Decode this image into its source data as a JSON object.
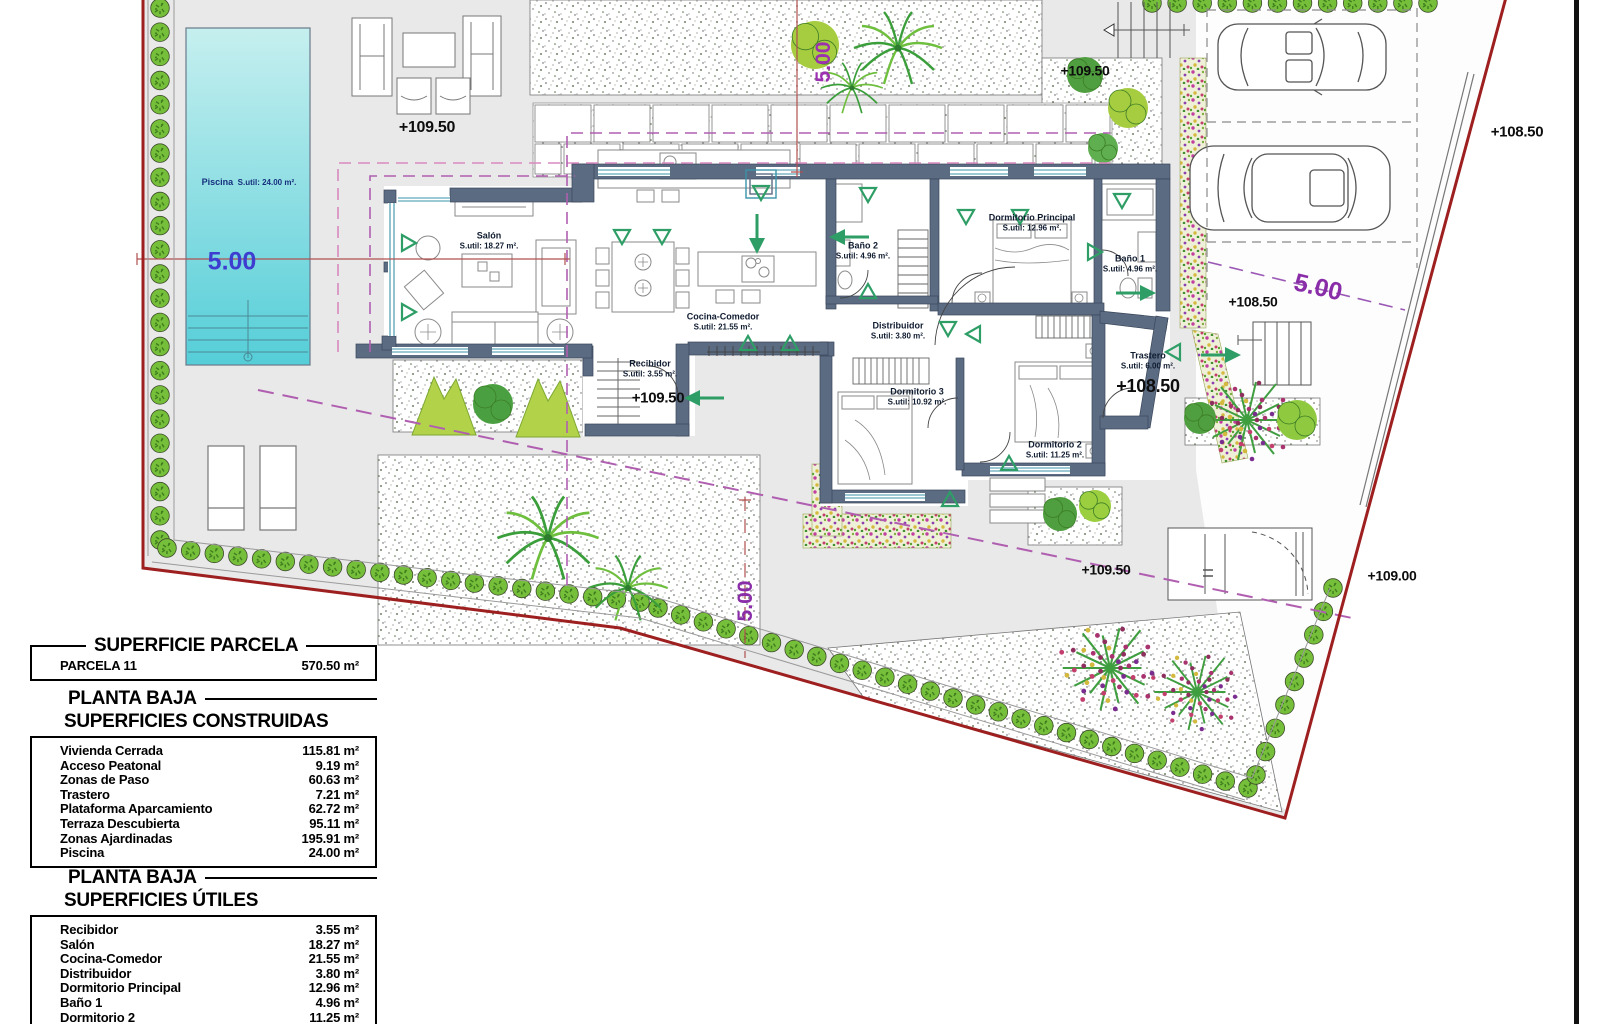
{
  "plan": {
    "pool": {
      "name": "Piscina",
      "area": "S.util: 24.00 m²."
    },
    "rooms": [
      {
        "name": "Salón",
        "area": "S.util: 18.27 m²."
      },
      {
        "name": "Cocina-Comedor",
        "area": "S.util: 21.55 m²."
      },
      {
        "name": "Recibidor",
        "area": "S.util: 3.55 m²."
      },
      {
        "name": "Baño 2",
        "area": "S.util: 4.96 m²."
      },
      {
        "name": "Distribuidor",
        "area": "S.util: 3.80 m²."
      },
      {
        "name": "Dormitorio 3",
        "area": "S.util: 10.92 m²."
      },
      {
        "name": "Dormitorio Principal",
        "area": "S.util: 12.96 m²."
      },
      {
        "name": "Baño 1",
        "area": "S.util: 4.96 m²."
      },
      {
        "name": "Trastero",
        "area": "S.util: 6.00 m²."
      },
      {
        "name": "Dormitorio 2",
        "area": "S.util: 11.25 m²."
      }
    ],
    "elevations": [
      {
        "text": "+109.50"
      },
      {
        "text": "+109.50"
      },
      {
        "text": "+108.50"
      },
      {
        "text": "+108.50"
      },
      {
        "text": "+108.50"
      },
      {
        "text": "+109.50"
      },
      {
        "text": "+109.50"
      },
      {
        "text": "+109.00"
      }
    ],
    "dimensions": [
      {
        "text": "5.00"
      },
      {
        "text": "5.00"
      },
      {
        "text": "5.00"
      },
      {
        "text": "5.00"
      }
    ]
  },
  "tables": {
    "parcela": {
      "title": "SUPERFICIE PARCELA",
      "rows": [
        {
          "label": "PARCELA 11",
          "value": "570.50 m²"
        }
      ]
    },
    "construidas": {
      "subtitle": "PLANTA BAJA",
      "title": "SUPERFICIES CONSTRUIDAS",
      "rows": [
        {
          "label": "Vivienda Cerrada",
          "value": "115.81 m²"
        },
        {
          "label": "Acceso Peatonal",
          "value": "9.19 m²"
        },
        {
          "label": "Zonas de Paso",
          "value": "60.63 m²"
        },
        {
          "label": "Trastero",
          "value": "7.21 m²"
        },
        {
          "label": "Plataforma Aparcamiento",
          "value": "62.72 m²"
        },
        {
          "label": "Terraza Descubierta",
          "value": "95.11 m²"
        },
        {
          "label": "Zonas Ajardinadas",
          "value": "195.91 m²"
        },
        {
          "label": "Piscina",
          "value": "24.00 m²"
        }
      ]
    },
    "utiles": {
      "subtitle": "PLANTA BAJA",
      "title": "SUPERFICIES ÚTILES",
      "rows": [
        {
          "label": "Recibidor",
          "value": "3.55 m²"
        },
        {
          "label": "Salón",
          "value": "18.27 m²"
        },
        {
          "label": "Cocina-Comedor",
          "value": "21.55 m²"
        },
        {
          "label": "Distribuidor",
          "value": "3.80 m²"
        },
        {
          "label": "Dormitorio Principal",
          "value": "12.96 m²"
        },
        {
          "label": "Baño 1",
          "value": "4.96 m²"
        },
        {
          "label": "Dormitorio 2",
          "value": "11.25 m²"
        }
      ]
    }
  },
  "colors": {
    "boundary": "#9e1f1f",
    "wall": "#5b6b82",
    "window": "#3a93a8",
    "pool_top": "#c6efef",
    "pool_bottom": "#55ced8",
    "hedge": "#76bf3a",
    "arrow": "#2e9e66",
    "dim_blue": "#3d3dd0",
    "dim_purple": "#8a2da8",
    "setback": "#b565b5"
  }
}
